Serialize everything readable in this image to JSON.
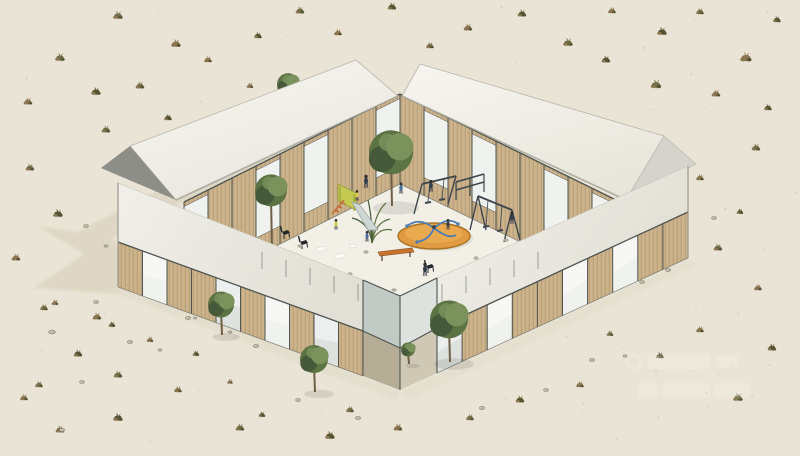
{
  "meta": {
    "kind": "architectural-rendering",
    "subject": "isometric-courtyard-building-with-playground-in-desert",
    "canvas": {
      "width": 800,
      "height": 456
    }
  },
  "watermark": {
    "present": true,
    "legible": false
  },
  "colors": {
    "sand": "#e9e4d5",
    "sandDark": "#ddd6c2",
    "shadow": "#d6cdb8",
    "floor": "#f1efe6",
    "roofL1": "#f7f6f1",
    "roofL2": "#e9e7de",
    "roofR1": "#f5f4ee",
    "roofR2": "#e7e5da",
    "roofEdge": "#b9b6aa",
    "gableDark": "#8e8e88",
    "gableLight": "#d4d3cc",
    "band1": "#f0efe9",
    "band2": "#e2e0d6",
    "top1": "#f6f5f0",
    "top2": "#edece3",
    "wood": "#ccb38c",
    "woodDark": "#b1986f",
    "glass": "#dde2df",
    "glassBright": "#f0f2ef",
    "glassDim": "#c2cac6",
    "interiorDim": "#a9b0aa",
    "frame": "#4e5450",
    "steel": "#777d77",
    "treeGreen": "#5c7344",
    "treeLight": "#7b925c",
    "treeDark": "#46593a",
    "trunk": "#6e5e45",
    "shrubOlive": "#6f6d46",
    "shrubBrown": "#8a7550",
    "shrubDark": "#555331",
    "rock": "#b7b1a2",
    "rockEdge": "#8f897b",
    "stone": "#b5b0a1",
    "orange": "#e09a41",
    "orangeDark": "#aa7426",
    "blue": "#4e7cb0",
    "slideYellow": "#c5ca52",
    "slideEdge": "#969c3a",
    "ladderOrange": "#c26f39",
    "metal": "#cfd7d5",
    "bench": "#c8742f",
    "benchEdge": "#8a4f1e",
    "figDark": "#333c4c",
    "figBlue": "#4a6f9f",
    "figYellow": "#d9c94b",
    "paper": "#fafaf6",
    "white": "#ffffff"
  },
  "scene": {
    "building": {
      "wings": [
        "back-left-gabled-wing",
        "back-right-gabled-wing",
        "front-left-low-wing",
        "front-right-low-wing"
      ],
      "courtyard": "central-playground-deck",
      "entry": "south-corner-notch"
    },
    "facades": [
      {
        "id": "back-left-courtyard-facade",
        "x0": 400,
        "y0t": 94,
        "y0b": 184,
        "x1": 184,
        "y1t": 202,
        "y1b": 292,
        "bays": "gwwgwgwwg",
        "style": "tall"
      },
      {
        "id": "back-right-courtyard-facade",
        "x0": 400,
        "y0t": 94,
        "y0b": 184,
        "x1": 616,
        "y1t": 200,
        "y1b": 288,
        "bays": "wgwgwwgwg",
        "style": "tall"
      },
      {
        "id": "front-left-outer-facade",
        "x0": 118,
        "y0t": 242,
        "y0b": 287,
        "x1": 363,
        "y1t": 331,
        "y1b": 376,
        "bays": "wgwwgwgwgw",
        "style": "mixed"
      },
      {
        "id": "front-right-outer-facade",
        "x0": 437,
        "y0t": 328,
        "y0b": 373,
        "x1": 688,
        "y1t": 212,
        "y1b": 258,
        "bays": "gwgwwgwgww",
        "style": "mixed"
      }
    ],
    "trees": [
      {
        "layer": "back",
        "x": 289,
        "y": 104,
        "r": 11,
        "h": 16
      },
      {
        "layer": "courtyard",
        "x": 392,
        "y": 206,
        "r": 22,
        "h": 46
      },
      {
        "layer": "courtyard",
        "x": 272,
        "y": 252,
        "r": 16,
        "h": 56
      },
      {
        "layer": "front",
        "x": 222,
        "y": 335,
        "r": 13,
        "h": 26
      },
      {
        "layer": "front",
        "x": 315,
        "y": 392,
        "r": 14,
        "h": 28
      },
      {
        "layer": "front",
        "x": 450,
        "y": 362,
        "r": 19,
        "h": 36
      },
      {
        "layer": "front",
        "x": 409,
        "y": 364,
        "r": 7,
        "h": 12
      }
    ],
    "shrubs": [
      [
        118,
        16,
        1
      ],
      [
        176,
        44,
        1
      ],
      [
        258,
        36,
        0.8
      ],
      [
        300,
        11,
        0.9
      ],
      [
        338,
        33,
        0.8
      ],
      [
        392,
        7,
        0.9
      ],
      [
        430,
        46,
        0.8
      ],
      [
        468,
        28,
        0.9
      ],
      [
        522,
        14,
        0.9
      ],
      [
        568,
        43,
        1
      ],
      [
        612,
        11,
        0.8
      ],
      [
        662,
        32,
        1
      ],
      [
        700,
        12,
        0.8
      ],
      [
        746,
        58,
        1.2
      ],
      [
        777,
        20,
        0.8
      ],
      [
        60,
        58,
        1
      ],
      [
        28,
        102,
        0.9
      ],
      [
        96,
        92,
        1
      ],
      [
        140,
        86,
        0.9
      ],
      [
        208,
        60,
        0.8
      ],
      [
        168,
        118,
        0.8
      ],
      [
        106,
        130,
        0.9
      ],
      [
        250,
        86,
        0.7
      ],
      [
        606,
        60,
        0.9
      ],
      [
        656,
        85,
        1.1
      ],
      [
        716,
        94,
        0.9
      ],
      [
        768,
        108,
        0.8
      ],
      [
        756,
        148,
        0.9
      ],
      [
        700,
        178,
        0.8
      ],
      [
        740,
        212,
        0.7
      ],
      [
        718,
        248,
        0.9
      ],
      [
        758,
        288,
        0.8
      ],
      [
        772,
        348,
        0.9
      ],
      [
        738,
        398,
        1
      ],
      [
        700,
        330,
        0.8
      ],
      [
        660,
        356,
        0.8
      ],
      [
        610,
        334,
        0.7
      ],
      [
        580,
        385,
        0.8
      ],
      [
        520,
        400,
        0.9
      ],
      [
        470,
        418,
        0.8
      ],
      [
        398,
        428,
        0.9
      ],
      [
        330,
        436,
        1
      ],
      [
        240,
        428,
        0.9
      ],
      [
        178,
        390,
        0.8
      ],
      [
        118,
        418,
        1
      ],
      [
        60,
        430,
        0.9
      ],
      [
        24,
        398,
        0.8
      ],
      [
        78,
        354,
        0.9
      ],
      [
        44,
        308,
        0.8
      ],
      [
        16,
        258,
        0.9
      ],
      [
        58,
        214,
        1
      ],
      [
        30,
        168,
        0.9
      ],
      [
        97,
        317,
        0.9
      ],
      [
        112,
        325,
        0.7
      ],
      [
        118,
        375,
        0.9
      ],
      [
        150,
        340,
        0.7
      ],
      [
        196,
        354,
        0.7
      ],
      [
        39,
        385,
        0.8
      ],
      [
        55,
        303,
        0.7
      ],
      [
        262,
        415,
        0.7
      ],
      [
        350,
        410,
        0.8
      ],
      [
        230,
        382,
        0.6
      ]
    ],
    "rocks": [
      [
        212,
        268,
        1
      ],
      [
        236,
        292,
        0.8
      ],
      [
        152,
        296,
        0.9
      ],
      [
        188,
        318,
        0.8
      ],
      [
        256,
        346,
        0.8
      ],
      [
        298,
        400,
        0.7
      ],
      [
        358,
        418,
        0.8
      ],
      [
        96,
        302,
        0.7
      ],
      [
        130,
        342,
        0.8
      ],
      [
        482,
        408,
        0.8
      ],
      [
        546,
        390,
        0.7
      ],
      [
        592,
        360,
        0.8
      ],
      [
        642,
        282,
        0.7
      ],
      [
        668,
        270,
        0.8
      ],
      [
        714,
        218,
        0.7
      ],
      [
        62,
        430,
        0.8
      ],
      [
        82,
        382,
        0.7
      ],
      [
        86,
        226,
        0.7
      ],
      [
        106,
        246,
        0.6
      ],
      [
        52,
        332,
        1
      ],
      [
        173,
        303,
        0.9
      ],
      [
        160,
        350,
        0.6
      ],
      [
        230,
        332,
        0.6
      ],
      [
        195,
        318,
        0.5
      ],
      [
        625,
        356,
        0.6
      ]
    ],
    "courtyard_stones": [
      [
        312,
        262
      ],
      [
        350,
        274
      ],
      [
        394,
        290
      ],
      [
        446,
        280
      ],
      [
        300,
        246
      ],
      [
        476,
        258
      ],
      [
        506,
        240
      ],
      [
        366,
        252
      ],
      [
        418,
        290
      ],
      [
        336,
        286
      ],
      [
        280,
        252
      ],
      [
        462,
        292
      ]
    ],
    "figures": [
      [
        366,
        186,
        "figDark",
        1
      ],
      [
        357,
        199,
        "figYellow",
        0.8
      ],
      [
        401,
        192,
        "figBlue",
        0.85
      ],
      [
        431,
        190,
        "figDark",
        0.9
      ],
      [
        336,
        228,
        "figYellow",
        0.8
      ],
      [
        367,
        240,
        "figBlue",
        0.8
      ],
      [
        448,
        228,
        "figDark",
        0.8
      ],
      [
        512,
        222,
        "figDark",
        0.9
      ],
      [
        425,
        274,
        "figDark",
        1
      ]
    ],
    "playground": {
      "equipment": [
        "slide-tower",
        "metal-chute",
        "climbing-ladder",
        "merry-go-round",
        "swing-frame",
        "pull-up-bars",
        "tall-swing",
        "bench",
        "chairs",
        "scattered-papers",
        "palm-plant"
      ]
    }
  }
}
